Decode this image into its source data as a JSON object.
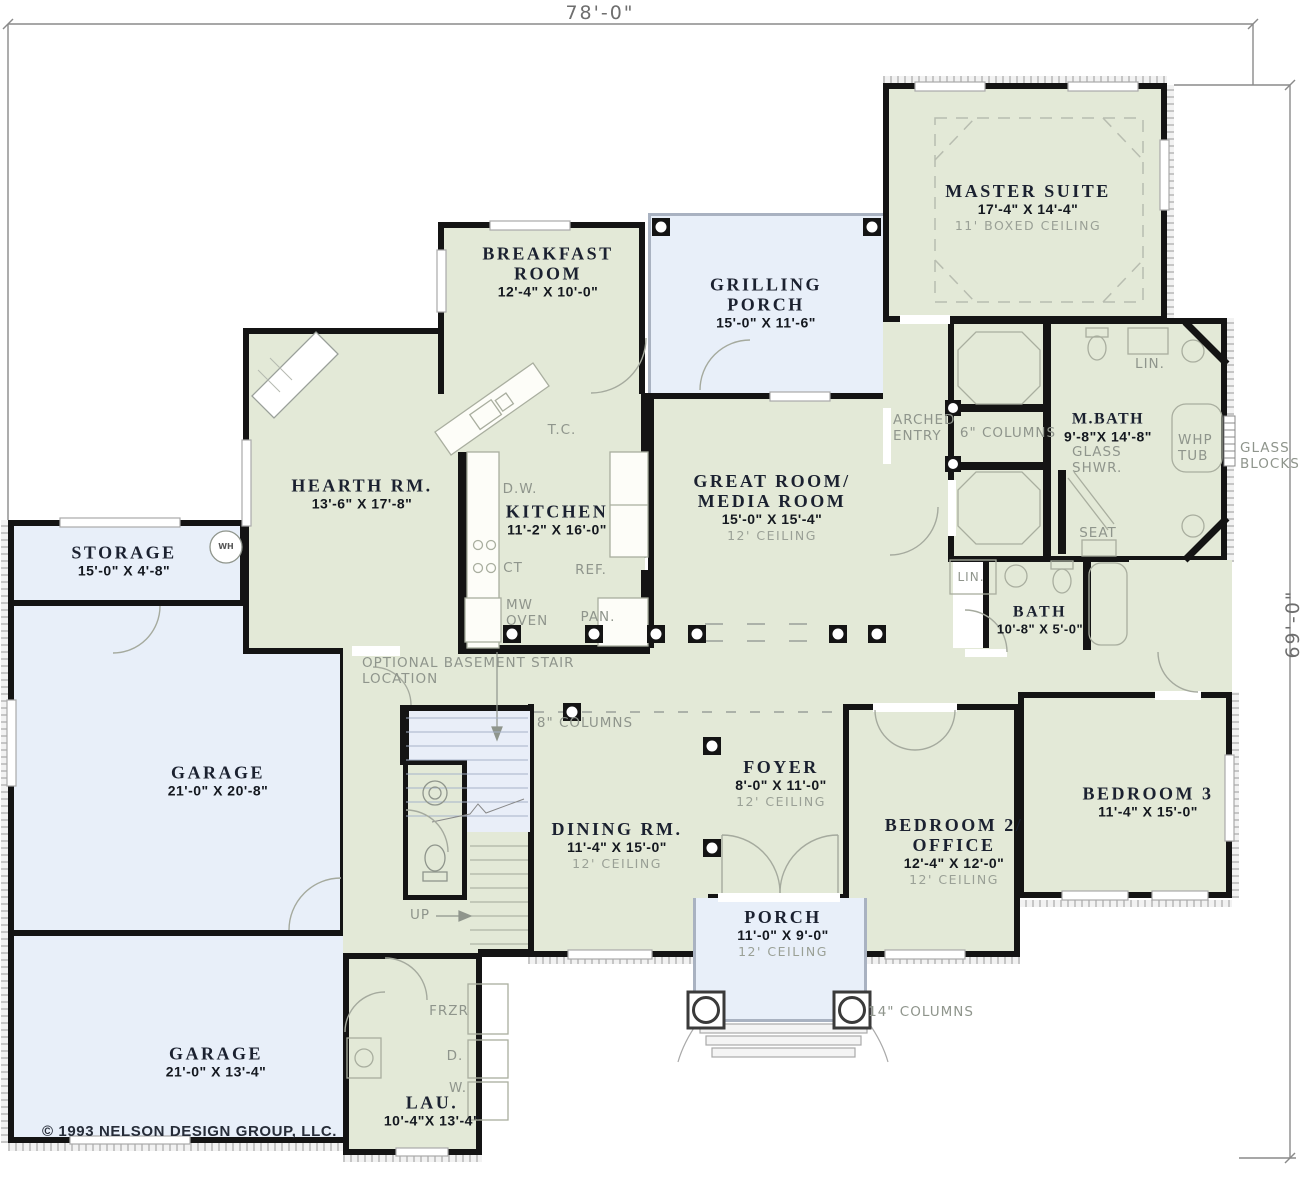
{
  "dims": {
    "top": "78'-0\"",
    "right": "69'-0\""
  },
  "copyright": "© 1993 NELSON DESIGN GROUP, LLC.",
  "colors": {
    "room_fill": "#e3e9d7",
    "porch_fill": "#e8eff9",
    "wall": "#141414",
    "annotation_gray": "#8f958c",
    "label_text": "#1b2130"
  },
  "rooms": [
    {
      "id": "master-suite",
      "name": "MASTER SUITE",
      "dims": "17'-4\" X 14'-4\"",
      "note": "11' BOXED CEILING"
    },
    {
      "id": "breakfast-room",
      "name": "BREAKFAST ROOM",
      "dims": "12'-4\" X 10'-0\"",
      "note": ""
    },
    {
      "id": "grilling-porch",
      "name": "GRILLING PORCH",
      "dims": "15'-0\" X 11'-6\"",
      "note": ""
    },
    {
      "id": "hearth-room",
      "name": "HEARTH RM.",
      "dims": "13'-6\" X 17'-8\"",
      "note": ""
    },
    {
      "id": "kitchen",
      "name": "KITCHEN",
      "dims": "11'-2\" X 16'-0\"",
      "note": ""
    },
    {
      "id": "great-room",
      "name": "GREAT ROOM/ MEDIA ROOM",
      "dims": "15'-0\" X 15'-4\"",
      "note": "12' CEILING"
    },
    {
      "id": "master-bath",
      "name": "M.BATH",
      "dims": "9'-8\"X 14'-8\"",
      "note": ""
    },
    {
      "id": "bath",
      "name": "BATH",
      "dims": "10'-8\" X 5'-0\"",
      "note": ""
    },
    {
      "id": "storage",
      "name": "STORAGE",
      "dims": "15'-0\" X 4'-8\"",
      "note": ""
    },
    {
      "id": "garage-upper",
      "name": "GARAGE",
      "dims": "21'-0\" X 20'-8\"",
      "note": ""
    },
    {
      "id": "garage-lower",
      "name": "GARAGE",
      "dims": "21'-0\" X 13'-4\"",
      "note": ""
    },
    {
      "id": "foyer",
      "name": "FOYER",
      "dims": "8'-0\" X 11'-0\"",
      "note": "12' CEILING"
    },
    {
      "id": "dining-room",
      "name": "DINING RM.",
      "dims": "11'-4\" X 15'-0\"",
      "note": "12' CEILING"
    },
    {
      "id": "bedroom-2",
      "name": "BEDROOM 2/ OFFICE",
      "dims": "12'-4\" X 12'-0\"",
      "note": "12' CEILING"
    },
    {
      "id": "bedroom-3",
      "name": "BEDROOM 3",
      "dims": "11'-4\" X 15'-0\"",
      "note": ""
    },
    {
      "id": "porch",
      "name": "PORCH",
      "dims": "11'-0\" X 9'-0\"",
      "note": "12' CEILING"
    },
    {
      "id": "laundry",
      "name": "LAU.",
      "dims": "10'-4\"X 13'-4\"",
      "note": ""
    }
  ],
  "labels": {
    "tc": "T.C.",
    "dw": "D.W.",
    "ct": "CT",
    "ref": "REF.",
    "mw_oven": "MW OVEN",
    "pan": "PAN.",
    "wh": "WH",
    "optional_basement": "OPTIONAL BASEMENT STAIR LOCATION",
    "columns8": "8\" COLUMNS",
    "columns6": "6\" COLUMNS",
    "columns14": "14\" COLUMNS",
    "up": "UP",
    "frzr": "FRZR",
    "dryer": "D.",
    "washer": "W.",
    "lin_mbath": "LIN.",
    "lin_bath": "LIN.",
    "glass_shwr": "GLASS SHWR.",
    "seat": "SEAT",
    "whp_tub": "WHP TUB",
    "glass_blocks": "GLASS BLOCKS",
    "arched_entry": "ARCHED ENTRY"
  }
}
